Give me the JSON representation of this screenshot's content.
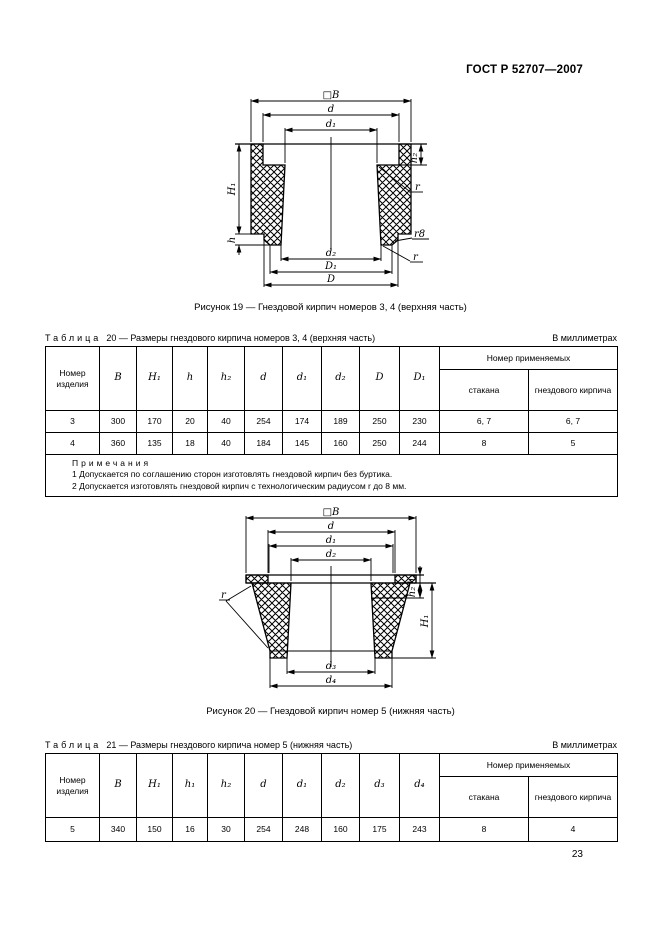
{
  "page": {
    "header": "ГОСТ Р 52707—2007",
    "number": "23"
  },
  "fig19": {
    "caption": "Рисунок 19 — Гнездовой кирпич номеров 3, 4 (верхняя часть)",
    "dims": {
      "B": "□B",
      "d": "d",
      "d1": "d₁",
      "d2": "d₂",
      "D1": "D₁",
      "D": "D",
      "H1": "H₁",
      "h": "h",
      "h2": "h₂",
      "r_top": "r",
      "r8": "r8",
      "r_bottom": "r"
    }
  },
  "table20": {
    "label": "Таблица",
    "number": "20",
    "title": "— Размеры гнездового кирпича номеров 3, 4 (верхняя часть)",
    "units": "В миллиметрах",
    "head": {
      "product": "Номер изделия",
      "cols": [
        "B",
        "H₁",
        "h",
        "h₂",
        "d",
        "d₁",
        "d₂",
        "D",
        "D₁"
      ],
      "group": "Номер применяемых",
      "sub": [
        "стакана",
        "гнездового кирпича"
      ]
    },
    "rows": [
      [
        "3",
        "300",
        "170",
        "20",
        "40",
        "254",
        "174",
        "189",
        "250",
        "230",
        "6, 7",
        "6, 7"
      ],
      [
        "4",
        "360",
        "135",
        "18",
        "40",
        "184",
        "145",
        "160",
        "250",
        "244",
        "8",
        "5"
      ]
    ],
    "notes_label": "Примечания",
    "notes": [
      "1 Допускается по соглашению сторон изготовлять гнездовой кирпич без буртика.",
      "2 Допускается изготовлять гнездовой кирпич с технологическим радиусом r до 8 мм."
    ]
  },
  "fig20": {
    "caption": "Рисунок 20 — Гнездовой кирпич номер 5 (нижняя часть)",
    "dims": {
      "B": "□B",
      "d": "d",
      "d1": "d₁",
      "d2": "d₂",
      "d3": "d₃",
      "d4": "d₄",
      "H1": "H₁",
      "h1": "h₁",
      "h2": "h₂",
      "r": "r"
    }
  },
  "table21": {
    "label": "Таблица",
    "number": "21",
    "title": "— Размеры гнездового кирпича номер 5 (нижняя часть)",
    "units": "В миллиметрах",
    "head": {
      "product": "Номер изделия",
      "cols": [
        "B",
        "H₁",
        "h₁",
        "h₂",
        "d",
        "d₁",
        "d₂",
        "d₃",
        "d₄"
      ],
      "group": "Номер применяемых",
      "sub": [
        "стакана",
        "гнездового кирпича"
      ]
    },
    "rows": [
      [
        "5",
        "340",
        "150",
        "16",
        "30",
        "254",
        "248",
        "160",
        "175",
        "243",
        "8",
        "4"
      ]
    ]
  }
}
